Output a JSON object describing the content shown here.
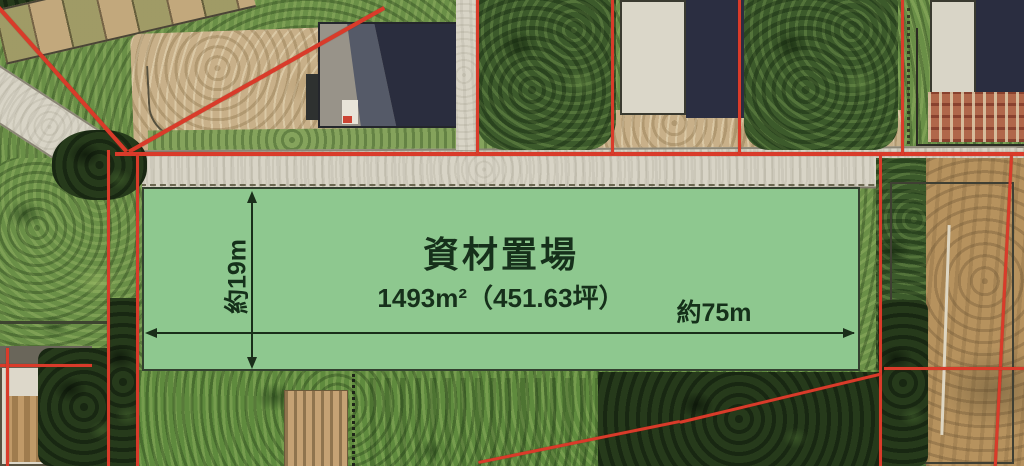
{
  "parcel_overlay": {
    "title": "資材置場",
    "area_label": "1493m²（451.63坪）",
    "width_label": "約75m",
    "height_label": "約19m",
    "fill_color": "#8ec88f",
    "border_color": "#33402f",
    "text_color": "#16301b"
  },
  "map": {
    "type": "aerial-photo",
    "boundary_line_color": "#d93b2a",
    "road_color": "#d8d4c6",
    "visible_features": [
      "roads",
      "house",
      "farm buildings",
      "trees",
      "garden plots",
      "fields",
      "red cadastral boundary lines"
    ]
  }
}
